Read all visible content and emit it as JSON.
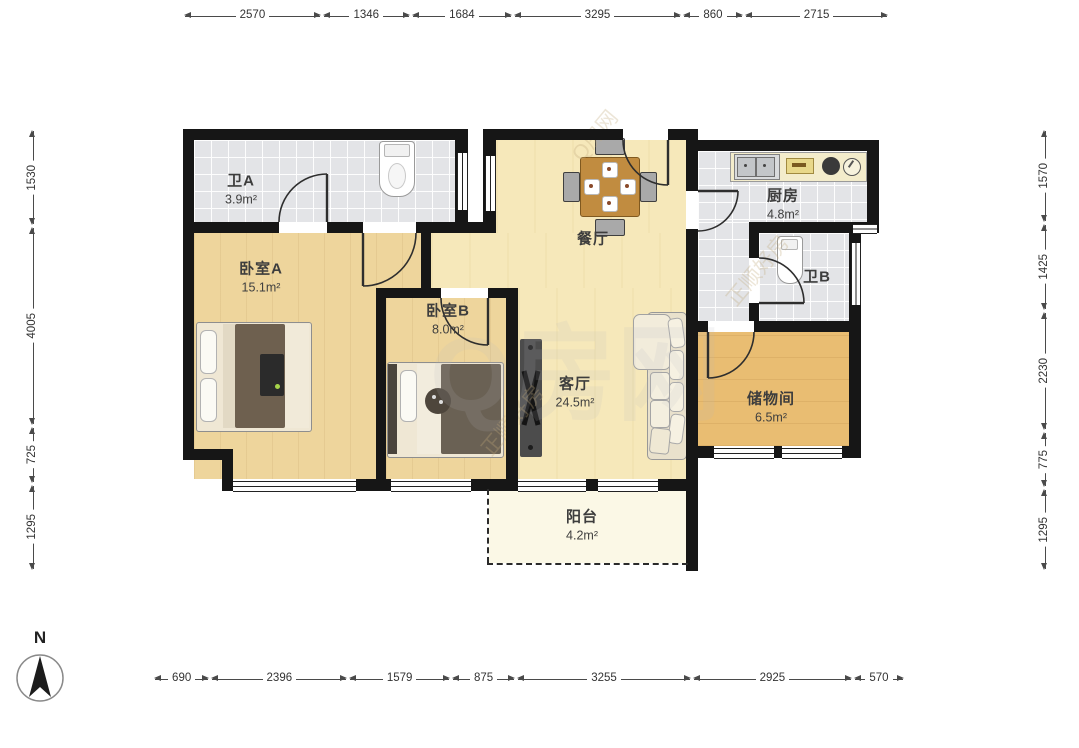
{
  "compass": {
    "label": "N"
  },
  "rooms": {
    "bath_a": {
      "name": "卫A",
      "area": "3.9m²"
    },
    "bed_a": {
      "name": "卧室A",
      "area": "15.1m²"
    },
    "bed_b": {
      "name": "卧室B",
      "area": "8.0m²"
    },
    "dining": {
      "name": "餐厅",
      "area": ""
    },
    "kitchen": {
      "name": "厨房",
      "area": "4.8m²"
    },
    "bath_b": {
      "name": "卫B",
      "area": ""
    },
    "storage": {
      "name": "储物间",
      "area": "6.5m²"
    },
    "living": {
      "name": "客厅",
      "area": "24.5m²"
    },
    "balcony": {
      "name": "阳台",
      "area": "4.2m²"
    }
  },
  "dimensions": {
    "top": [
      "2570",
      "1346",
      "1684",
      "3295",
      "860",
      "2715"
    ],
    "bottom": [
      "690",
      "2396",
      "1579",
      "875",
      "3255",
      "2925",
      "570"
    ],
    "left": [
      "1530",
      "4005",
      "725",
      "1295"
    ],
    "right": [
      "1570",
      "1425",
      "2230",
      "775",
      "1295"
    ]
  },
  "watermark": {
    "primary": "Q房网",
    "secondary": "正顺好房"
  }
}
